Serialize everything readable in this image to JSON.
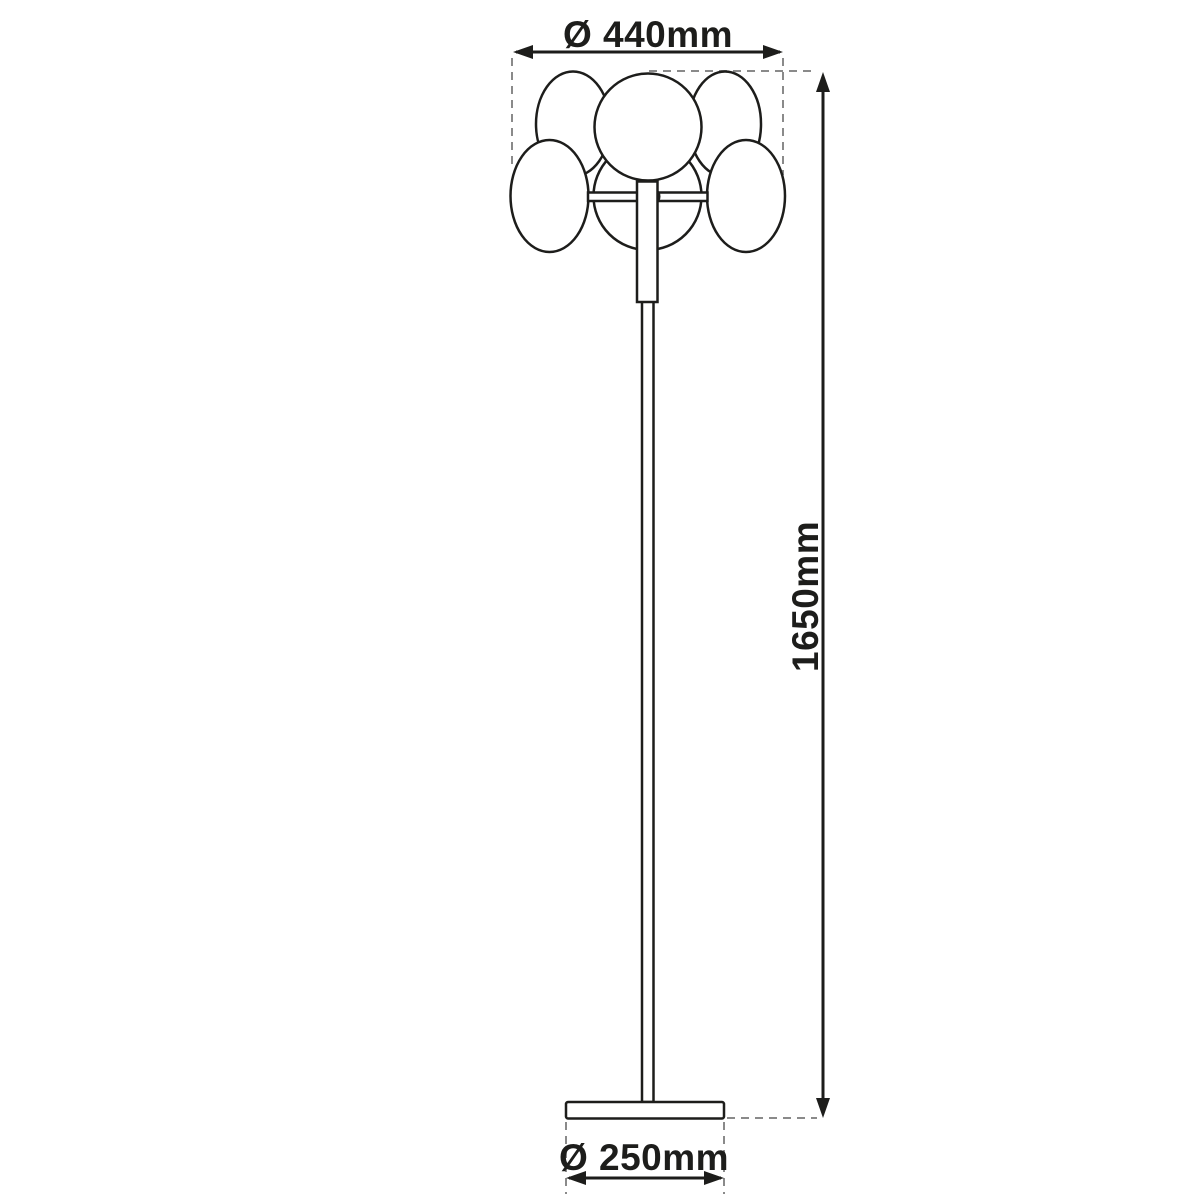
{
  "page": {
    "background": "#ffffff"
  },
  "drawing": {
    "type": "product-dimension-diagram",
    "subject": "floor-lamp-line-drawing",
    "colors": {
      "outline": "#1d1d1b",
      "dimension_line": "#1d1d1b",
      "dashed_guide": "#8a8a8a"
    },
    "lamp": {
      "shade_count": 6,
      "head_parts": [
        "center-globe",
        "upper-left-disc",
        "upper-right-disc",
        "lower-left-disc",
        "lower-right-disc",
        "rear-globe"
      ],
      "body_parts": [
        "head-stem",
        "pole",
        "round-base"
      ]
    },
    "dimensions": {
      "shade_diameter": {
        "label": "Ø 440mm",
        "value_mm": 440,
        "symbol": "diameter"
      },
      "total_height": {
        "label": "1650mm",
        "value_mm": 1650
      },
      "base_diameter": {
        "label": "Ø 250mm",
        "value_mm": 250,
        "symbol": "diameter"
      }
    }
  }
}
